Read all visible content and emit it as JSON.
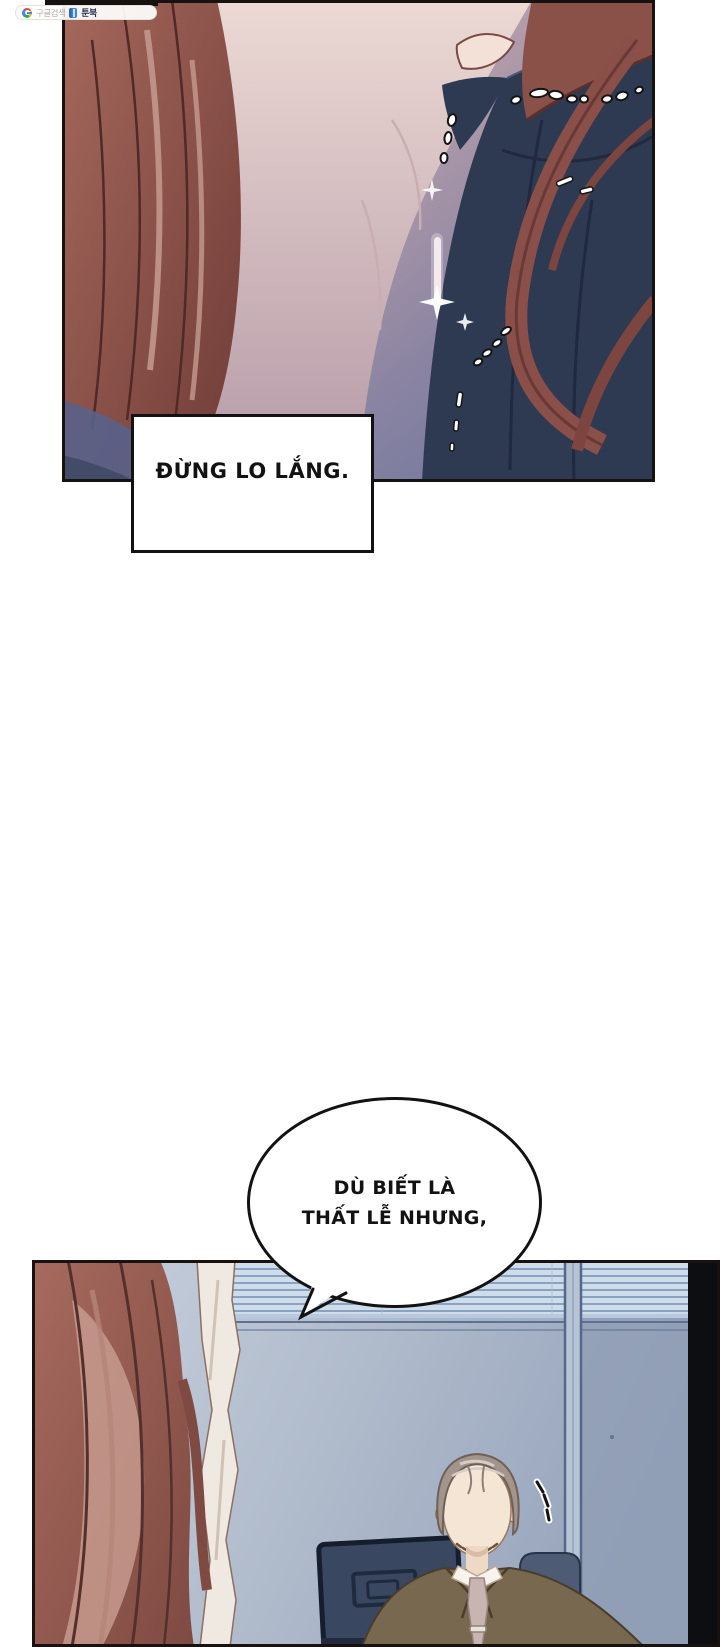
{
  "canvas": {
    "width": 720,
    "height": 1647,
    "background": "#ffffff"
  },
  "watermark": {
    "google_icon": "google-g",
    "search_label": "구글검색",
    "book_icon": "toonbook-book",
    "brand_label": "툰북"
  },
  "caption_box": {
    "text": "ĐỪNG LO LẮNG."
  },
  "speech_bubble": {
    "line1": "DÙ BIẾT LÀ",
    "line2": "THẤT LỄ NHƯNG,"
  },
  "panel1": {
    "description": "close-up of woman with long auburn hair, navy off-shoulder dress, pearl necklace and sparkling pendant",
    "colors": {
      "background_pink": "#dcc6c8",
      "background_slate": "#66719a",
      "hair_auburn": "#9c5f54",
      "dress_navy": "#2e3a52",
      "skin": "#ead7d3",
      "necklace_beads": "#ffffff"
    }
  },
  "panel2": {
    "description": "office scene: grey-haired man in olive suit before window blinds, wall monitor, auburn hair in foreground",
    "colors": {
      "wall": "#c8d1dd",
      "blinds": "#cfdcea",
      "foreground_hair": "#a2675c",
      "curtain": "#efe9e1",
      "suit": "#78684f",
      "shirt": "#f8f3ec",
      "tie": "#c8b5b1",
      "monitor": "#3a4760",
      "man_hair": "#a3948c",
      "right_strip": "#0d0e12"
    }
  }
}
